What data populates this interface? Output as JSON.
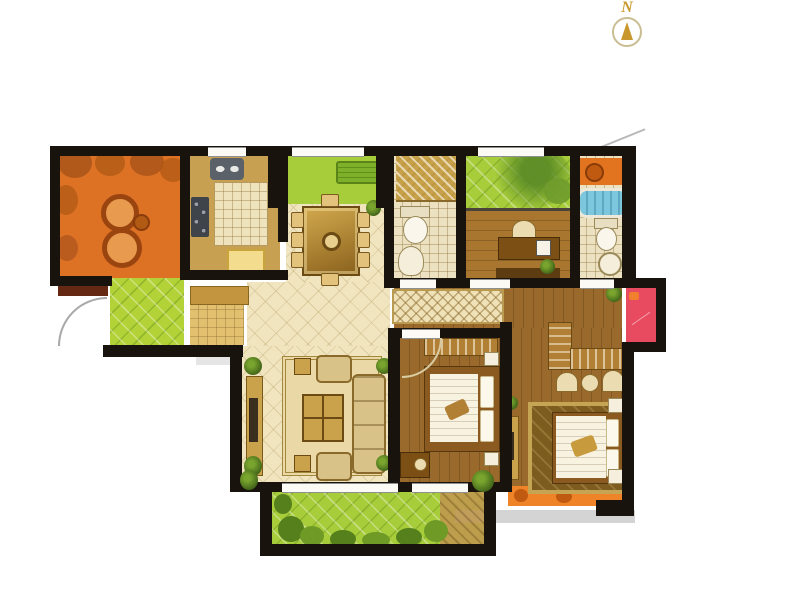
{
  "compass": {
    "label": "N"
  },
  "palette": {
    "wall": "#18130d",
    "tile_cream": "#f1e5c0",
    "kitchen_floor": "#c7a052",
    "entry_green": "#b2d238",
    "garden_green": "#a7cd3b",
    "wood": "#9a6a2c",
    "wood_light": "#a8762f",
    "balcony_orange": "#dd7225",
    "balcony_orange_south": "#ef8327",
    "platform_red": "#e84a5f",
    "sill_maroon": "#652812",
    "tub_blue": "#7cc7de",
    "counter_orange": "#e2731f",
    "mat_tan": "#e2c070",
    "cabinet_tan": "#c3953f",
    "rug_cream": "#ead9a6",
    "rug_master": "#7c5d1f",
    "shadow_gray": "#d4d4d4",
    "compass_gold": "#c8982e"
  }
}
